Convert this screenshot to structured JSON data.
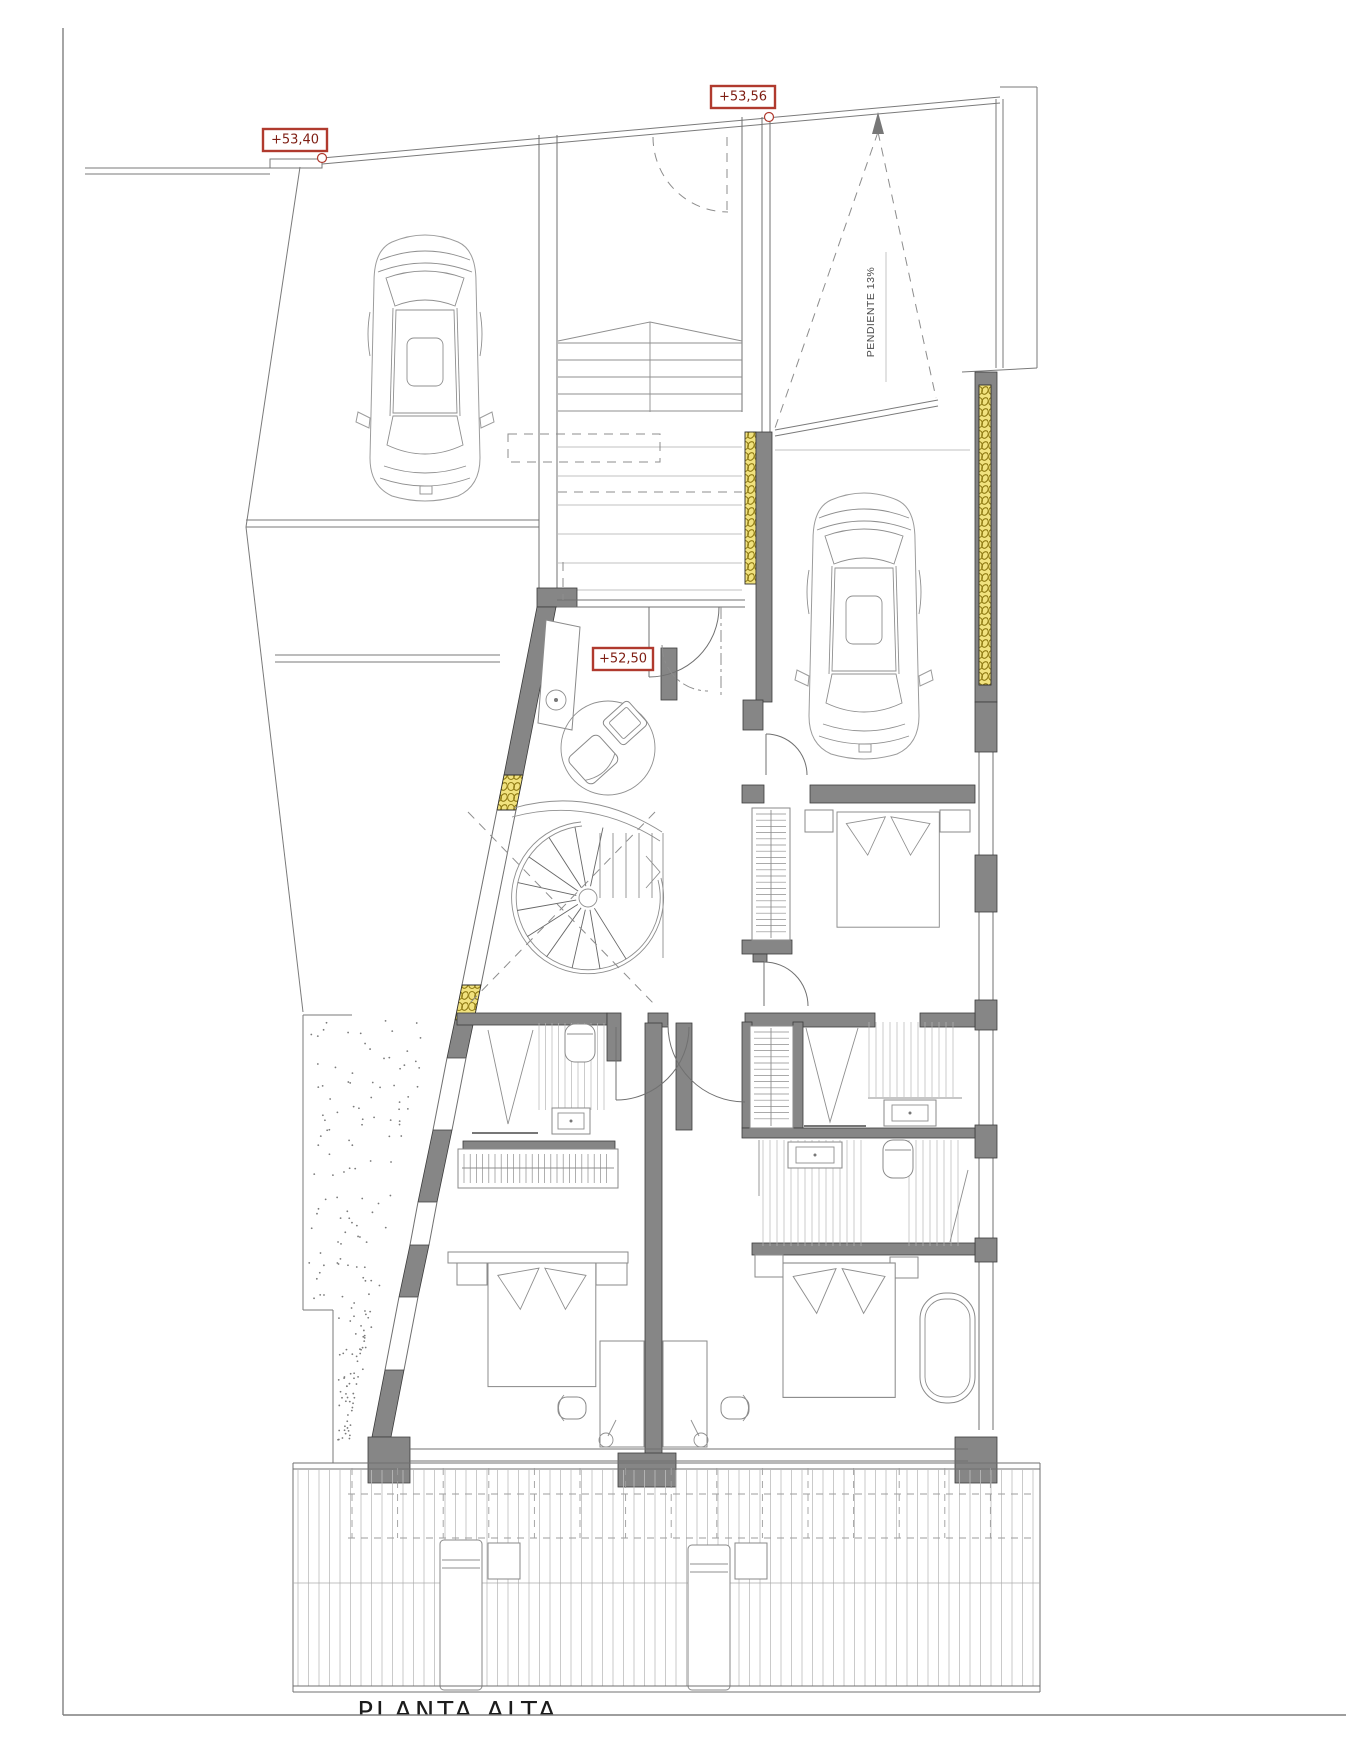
{
  "drawing": {
    "title": "PLANTA ALTA",
    "labels": {
      "level_parking": "+53,40",
      "level_street": "+53,56",
      "level_entry": "+52,50",
      "ramp_slope": "PENDIENTE 13%"
    },
    "colors": {
      "marker_border": "#b03a2e",
      "marker_text": "#7e1d12",
      "wall_fill": "#868686",
      "insulation_fill": "#f1e27e",
      "insulation_stroke": "#8f7a12",
      "line_gray": "#707070"
    }
  }
}
